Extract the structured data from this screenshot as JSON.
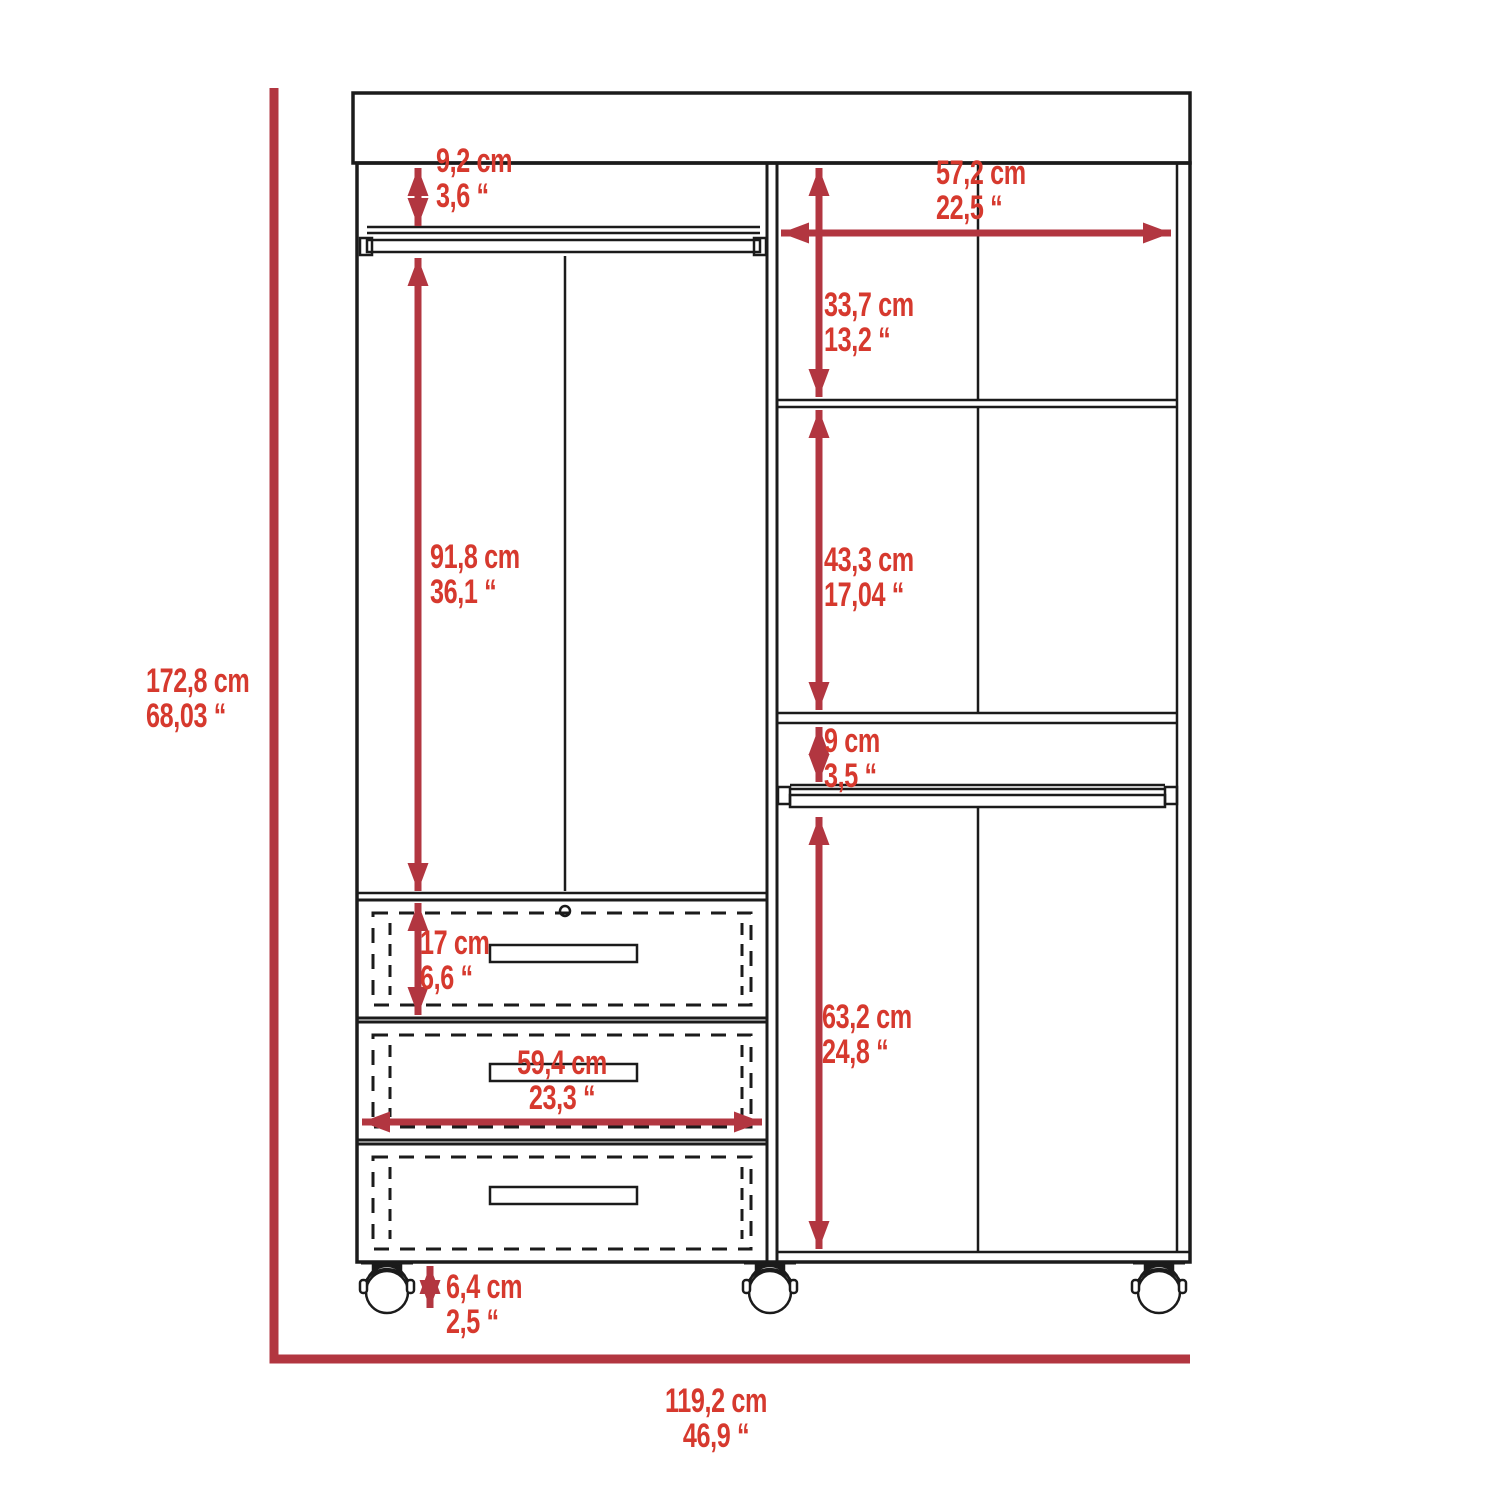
{
  "diagram": {
    "subject": "wardrobe-closet-dimension-drawing",
    "colors": {
      "background": "#ffffff",
      "outline": "#1b1b1b",
      "dimension_line": "#b23640",
      "dimension_text": "#d6392e"
    },
    "dimensions": {
      "top_gap": {
        "cm": "9,2 cm",
        "in": "3,6 “"
      },
      "right_width": {
        "cm": "57,2 cm",
        "in": "22,5 “"
      },
      "upper_right": {
        "cm": "33,7 cm",
        "in": "13,2 “"
      },
      "left_hanging": {
        "cm": "91,8 cm",
        "in": "36,1 “"
      },
      "middle_right": {
        "cm": "43,3 cm",
        "in": "17,04 “"
      },
      "rod_gap": {
        "cm": "9 cm",
        "in": "3,5 “"
      },
      "overall_height": {
        "cm": "172,8 cm",
        "in": "68,03 “"
      },
      "drawer_height": {
        "cm": "17 cm",
        "in": "6,6 “"
      },
      "drawer_width": {
        "cm": "59,4 cm",
        "in": "23,3 “"
      },
      "lower_right": {
        "cm": "63,2 cm",
        "in": "24,8 “"
      },
      "caster_height": {
        "cm": "6,4 cm",
        "in": "2,5 “"
      },
      "overall_width": {
        "cm": "119,2 cm",
        "in": "46,9 “"
      }
    }
  }
}
